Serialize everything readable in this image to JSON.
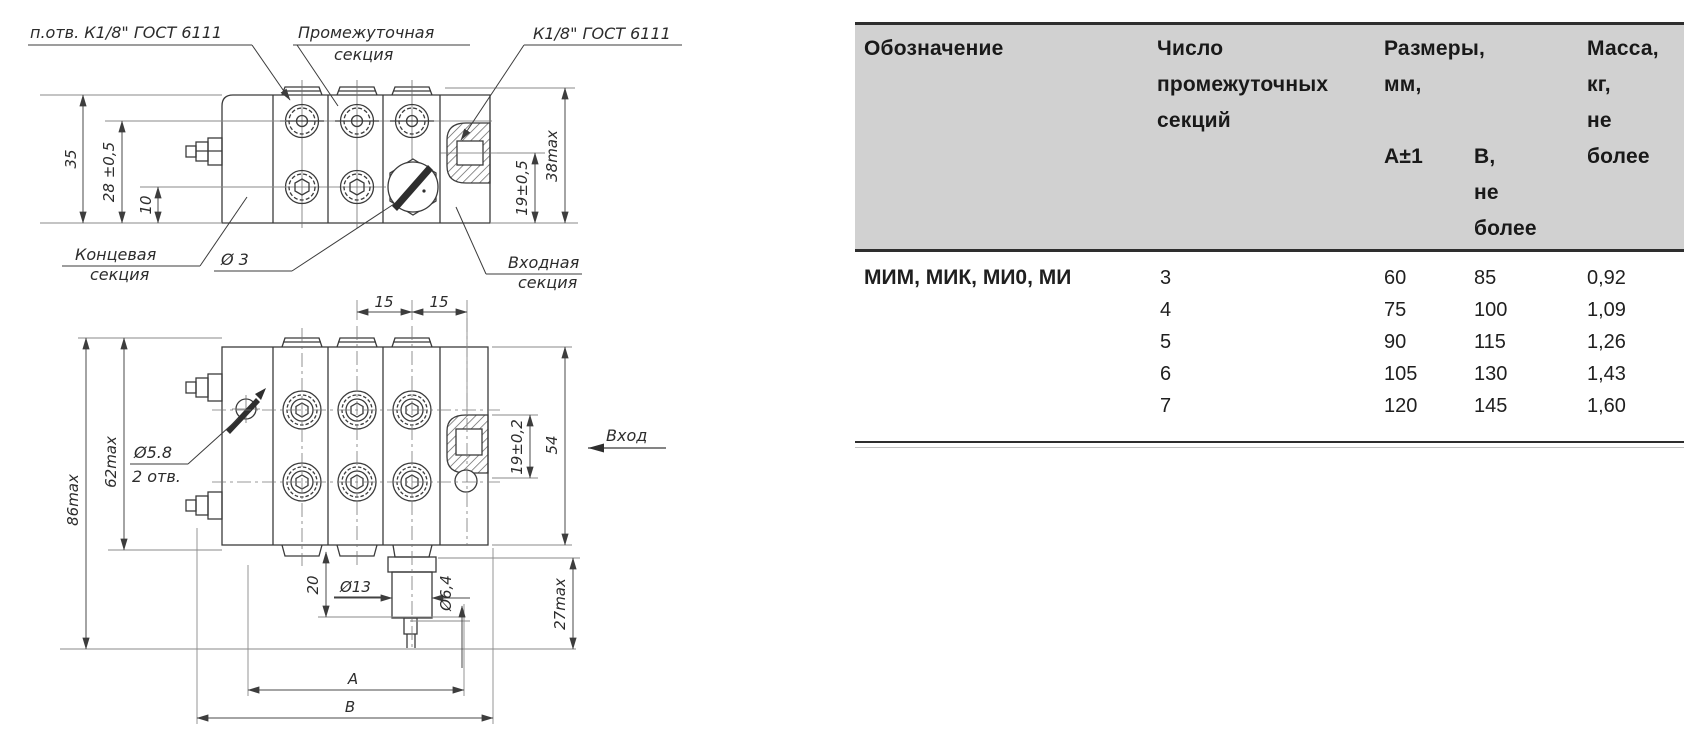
{
  "drawing": {
    "callouts": {
      "tap_hole": "п.отв. К1/8\" ГОСТ 6111",
      "intermediate_1": "Промежуточная",
      "intermediate_2": "секция",
      "inlet_thread": "К1/8\" ГОСТ 6111",
      "end_1": "Концевая",
      "end_2": "секция",
      "needle_dia": "Ø 3",
      "inlet_1": "Входная",
      "inlet_2": "секция",
      "inlet_flow": "Вход",
      "hole_dia": "Ø5.8",
      "hole_qty": "2 отв."
    },
    "dims": {
      "h35": "35",
      "h28": "28 ±0,5",
      "h10": "10",
      "h19_05": "19±0,5",
      "h38": "38max",
      "w15a": "15",
      "w15b": "15",
      "h86": "86max",
      "h62": "62max",
      "h19_02": "19±0,2",
      "h54": "54",
      "d20": "20",
      "d13": "Ø13",
      "d64": "Ø6,4",
      "h27": "27max",
      "dimA": "A",
      "dimB": "B"
    }
  },
  "table": {
    "headers": {
      "designation": "Обозначение",
      "sections": [
        "Число",
        "промежуточных",
        "секций"
      ],
      "dimensions": [
        "Размеры,",
        "мм,"
      ],
      "sub_a": "А±1",
      "sub_b": [
        "В,",
        "не",
        "более"
      ],
      "mass": [
        "Масса,",
        "кг,",
        "не",
        "более"
      ]
    },
    "designation_value": "МИМ, МИК, МИ0, МИ",
    "rows": [
      {
        "sections": "3",
        "a": "60",
        "b": "85",
        "mass": "0,92"
      },
      {
        "sections": "4",
        "a": "75",
        "b": "100",
        "mass": "1,09"
      },
      {
        "sections": "5",
        "a": "90",
        "b": "115",
        "mass": "1,26"
      },
      {
        "sections": "6",
        "a": "105",
        "b": "130",
        "mass": "1,43"
      },
      {
        "sections": "7",
        "a": "120",
        "b": "145",
        "mass": "1,60"
      }
    ],
    "header_fill": "#d1d1d1",
    "rule_color": "#2e2e2e"
  }
}
